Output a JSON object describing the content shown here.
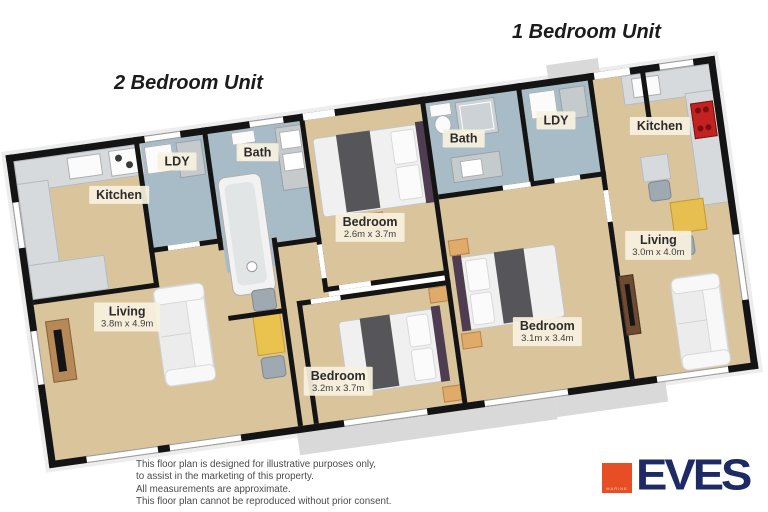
{
  "titles": {
    "unit2": "2 Bedroom Unit",
    "unit1": "1 Bedroom Unit"
  },
  "rooms": {
    "u2_kitchen": {
      "name": "Kitchen"
    },
    "u2_ldy": {
      "name": "LDY"
    },
    "u2_bath": {
      "name": "Bath"
    },
    "u2_bedroom1": {
      "name": "Bedroom",
      "dims": "2.6m x 3.7m"
    },
    "u2_living": {
      "name": "Living",
      "dims": "3.8m x 4.9m"
    },
    "u2_bedroom2": {
      "name": "Bedroom",
      "dims": "3.2m x 3.7m"
    },
    "u1_bath": {
      "name": "Bath"
    },
    "u1_ldy": {
      "name": "LDY"
    },
    "u1_kitchen": {
      "name": "Kitchen"
    },
    "u1_bedroom": {
      "name": "Bedroom",
      "dims": "3.1m x 3.4m"
    },
    "u1_living": {
      "name": "Living",
      "dims": "3.0m x 4.0m"
    }
  },
  "disclaimer": {
    "line1": "This floor plan is designed for illustrative purposes only,",
    "line2": "to assist in the marketing of this property.",
    "line3": "All measurements are approximate.",
    "line4": "This floor plan cannot be reproduced without prior consent."
  },
  "logo": {
    "brand": "EVES",
    "sub": "MARINE"
  },
  "colors": {
    "floor_beige": "#d9c49c",
    "floor_wet": "#a8bcc7",
    "wall": "#141414",
    "label_bg": "#f6f0df",
    "accent_orange": "#e84e25",
    "brand_navy": "#1e2a64",
    "patio_grey": "#d9d9d9",
    "table_yellow": "#eac24e",
    "wood": "#b68a58",
    "headboard_purple": "#4e3d50"
  }
}
